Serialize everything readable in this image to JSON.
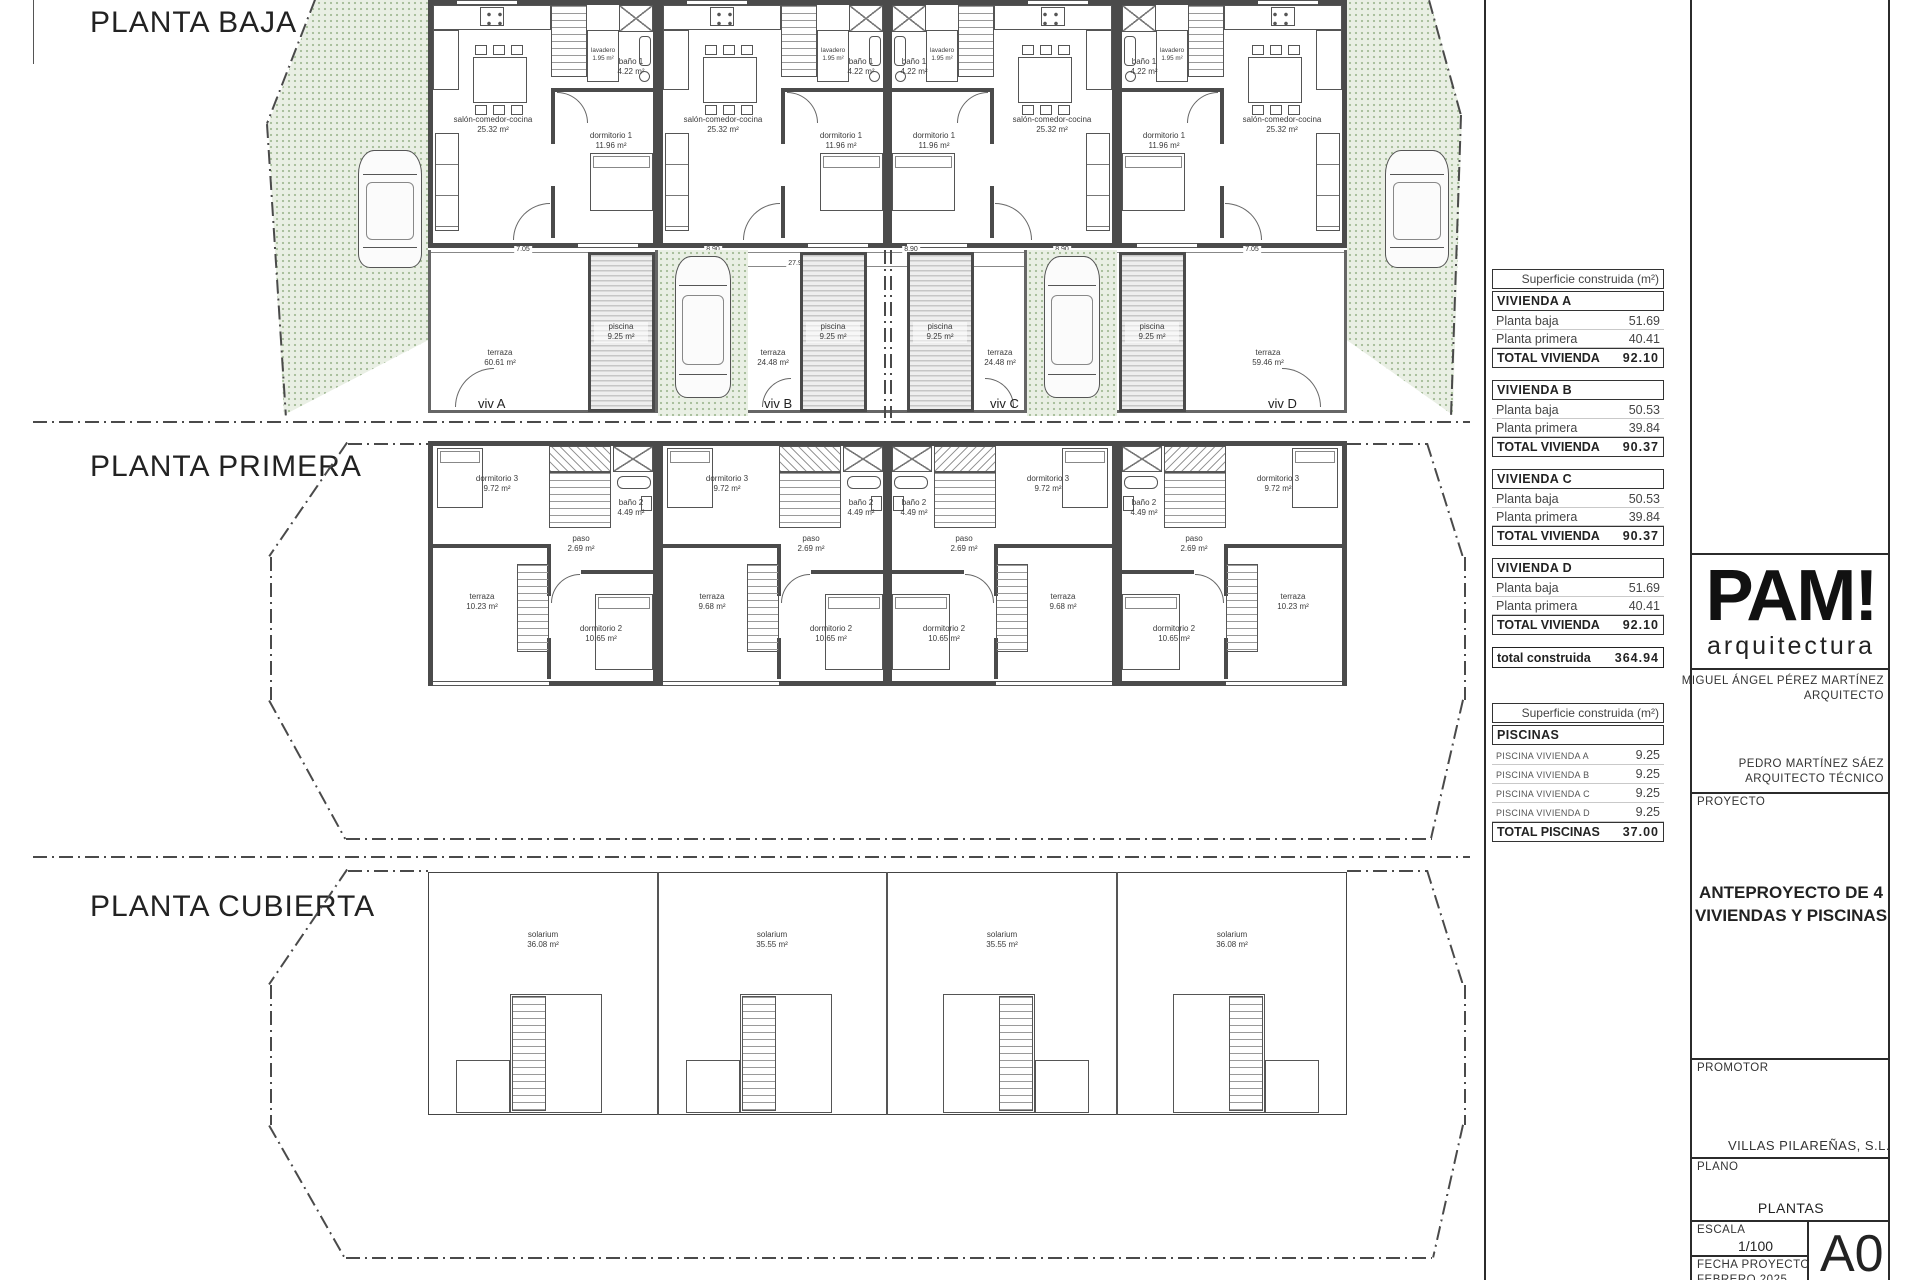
{
  "titles": {
    "baja": "PLANTA BAJA",
    "primera": "PLANTA PRIMERA",
    "cubierta": "PLANTA CUBIERTA"
  },
  "rooms_baja": {
    "salon": {
      "name": "salón-comedor-cocina",
      "area": "25.32 m²"
    },
    "lavadero": {
      "name": "lavadero",
      "area": "1.95 m²"
    },
    "bano1": {
      "name": "baño 1",
      "area": "4.22 m²"
    },
    "dorm1": {
      "name": "dormitorio 1",
      "area": "11.96 m²"
    }
  },
  "rooms_primera": {
    "dorm3": {
      "name": "dormitorio 3",
      "area": "9.72 m²"
    },
    "bano2": {
      "name": "baño 2",
      "area": "4.49 m²"
    },
    "paso": {
      "name": "paso",
      "area": "2.69 m²"
    },
    "dorm2": {
      "name": "dormitorio 2",
      "area": "10.65 m²"
    },
    "terraza_outer": {
      "name": "terraza",
      "area": "10.23 m²"
    },
    "terraza_inner": {
      "name": "terraza",
      "area": "9.68 m²"
    }
  },
  "cubierta": {
    "solarium_outer": {
      "name": "solarium",
      "area": "36.08 m²"
    },
    "solarium_inner": {
      "name": "solarium",
      "area": "35.55 m²"
    }
  },
  "strip": {
    "terraza_a": {
      "name": "terraza",
      "area": "60.61 m²"
    },
    "terraza_b": {
      "name": "terraza",
      "area": "24.48 m²"
    },
    "terraza_c": {
      "name": "terraza",
      "area": "24.48 m²"
    },
    "terraza_d": {
      "name": "terraza",
      "area": "59.46 m²"
    },
    "piscina": {
      "name": "piscina",
      "area": "9.25 m²"
    },
    "viv_a": "viv A",
    "viv_b": "viv B",
    "viv_c": "viv C",
    "viv_d": "viv D"
  },
  "dims": {
    "d1": "7.05",
    "d2": "8.90",
    "d3": "8.90",
    "d4": "8.90",
    "d5": "7.05",
    "total": "27.90"
  },
  "areas_table": {
    "header": "Superficie construida (m²)",
    "blocks": [
      {
        "title": "VIVIENDA A",
        "rows": [
          {
            "label": "Planta baja",
            "value": "51.69"
          },
          {
            "label": "Planta primera",
            "value": "40.41"
          }
        ],
        "total_label": "TOTAL VIVIENDA",
        "total_value": "92.10"
      },
      {
        "title": "VIVIENDA B",
        "rows": [
          {
            "label": "Planta baja",
            "value": "50.53"
          },
          {
            "label": "Planta primera",
            "value": "39.84"
          }
        ],
        "total_label": "TOTAL VIVIENDA",
        "total_value": "90.37"
      },
      {
        "title": "VIVIENDA C",
        "rows": [
          {
            "label": "Planta baja",
            "value": "50.53"
          },
          {
            "label": "Planta primera",
            "value": "39.84"
          }
        ],
        "total_label": "TOTAL VIVIENDA",
        "total_value": "90.37"
      },
      {
        "title": "VIVIENDA D",
        "rows": [
          {
            "label": "Planta baja",
            "value": "51.69"
          },
          {
            "label": "Planta primera",
            "value": "40.41"
          }
        ],
        "total_label": "TOTAL VIVIENDA",
        "total_value": "92.10"
      }
    ],
    "grand_label": "total construida",
    "grand_value": "364.94"
  },
  "pools_table": {
    "header": "Superficie construida (m²)",
    "title": "PISCINAS",
    "rows": [
      {
        "label": "PISCINA VIVIENDA A",
        "value": "9.25"
      },
      {
        "label": "PISCINA VIVIENDA B",
        "value": "9.25"
      },
      {
        "label": "PISCINA VIVIENDA C",
        "value": "9.25"
      },
      {
        "label": "PISCINA VIVIENDA D",
        "value": "9.25"
      }
    ],
    "total_label": "TOTAL PISCINAS",
    "total_value": "37.00"
  },
  "titleblock": {
    "logo": "PAM!",
    "logo_sub": "arquitectura",
    "architect_name": "MIGUEL ÁNGEL PÉREZ MARTÍNEZ",
    "architect_role": "ARQUITECTO",
    "tech_name": "PEDRO MARTÍNEZ SÁEZ",
    "tech_role": "ARQUITECTO TÉCNICO",
    "proyecto_label": "PROYECTO",
    "proyecto_line1": "ANTEPROYECTO DE  4",
    "proyecto_line2": "VIVIENDAS Y PISCINAS",
    "promotor_label": "PROMOTOR",
    "promotor_value": "VILLAS PILAREÑAS, S.L.",
    "plano_label": "PLANO",
    "plano_value": "PLANTAS",
    "escala_label": "ESCALA",
    "escala_value": "1/100",
    "fecha_label": "FECHA PROYECTO",
    "fecha_value": "FEBRERO 2025",
    "sheet_size": "A0"
  }
}
